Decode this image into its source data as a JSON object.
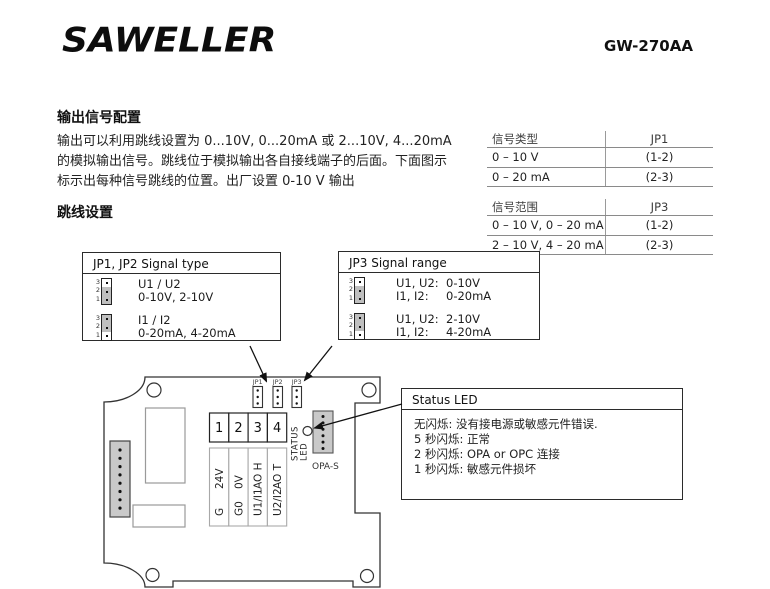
{
  "header": {
    "logo": "SAWELLER",
    "model": "GW-270AA"
  },
  "output_config": {
    "title": "输出信号配置",
    "lines": [
      "输出可以利用跳线设置为 0...10V, 0...20mA 或 2...10V, 4...20mA",
      "的模拟输出信号。跳线位于模拟输出各自接线端子的后面。下面图示",
      "标示出每种信号跳线的位置。出厂设置 0-10 V 输出"
    ]
  },
  "jumper_settings_title": "跳线设置",
  "tables": [
    {
      "header": [
        "信号类型",
        "JP1"
      ],
      "rows": [
        [
          "0 – 10 V",
          "(1-2)"
        ],
        [
          "0 – 20 mA",
          "(2-3)"
        ]
      ]
    },
    {
      "header": [
        "信号范围",
        "JP3"
      ],
      "rows": [
        [
          "0 – 10 V, 0 – 20 mA",
          "(1-2)"
        ],
        [
          "2 – 10 V, 4 – 20 mA",
          "(2-3)"
        ]
      ]
    }
  ],
  "jumper_pins": [
    "3",
    "2",
    "1"
  ],
  "jp12_box": {
    "title": "JP1, JP2 Signal type",
    "rows": [
      {
        "cap": "1-2",
        "line1": "U1 / U2",
        "line2": "0-10V, 2-10V"
      },
      {
        "cap": "2-3",
        "line1": "I1 / I2",
        "line2": "0-20mA, 4-20mA"
      }
    ]
  },
  "jp3_box": {
    "title": "JP3 Signal range",
    "rows": [
      {
        "cap": "1-2",
        "items": [
          {
            "label": "U1, U2:",
            "value": "0-10V"
          },
          {
            "label": "I1, I2:",
            "value": "0-20mA"
          }
        ]
      },
      {
        "cap": "2-3",
        "items": [
          {
            "label": "U1, U2:",
            "value": "2-10V"
          },
          {
            "label": "I1, I2:",
            "value": "4-20mA"
          }
        ]
      }
    ]
  },
  "status_box": {
    "title": "Status LED",
    "lines": [
      "无闪烁: 没有接电源或敏感元件错误.",
      "5 秒闪烁: 正常",
      "2 秒闪烁: OPA or OPC 连接",
      "1 秒闪烁: 敏感元件损坏"
    ]
  },
  "board": {
    "jumper_labels": [
      "JP1",
      "JP2",
      "JP3"
    ],
    "terminal_numbers": [
      "1",
      "2",
      "3",
      "4"
    ],
    "terminal_labels": [
      {
        "top": "24V",
        "bottom": "G"
      },
      {
        "top": "0V",
        "bottom": "G0"
      },
      {
        "top": "AO H",
        "bottom": "U1/I1"
      },
      {
        "top": "AO T",
        "bottom": "U2/I2"
      }
    ],
    "status_led_word1": "STATUS",
    "status_led_word2": "LED",
    "opa_label": "OPA-S"
  },
  "colors": {
    "ink": "#1a1a1a",
    "grey_fill": "#c9c9c9",
    "rule_grey": "#8a8a8a"
  }
}
